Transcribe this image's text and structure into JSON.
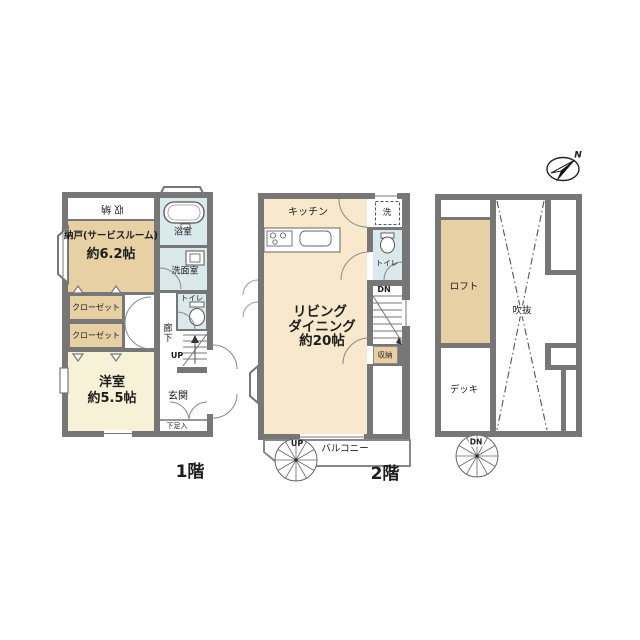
{
  "compass": {
    "north": "N"
  },
  "colors": {
    "wall": "#777777",
    "room_tan": "#e6d0a4",
    "room_cream": "#f6f1d7",
    "room_peach": "#f8e9cd",
    "room_blue": "#d9e9ec"
  },
  "floor1": {
    "label": "1階",
    "closet_top": "収納",
    "service_room_name": "納戸(サービスルーム)",
    "service_room_size": "約6.2帖",
    "bathroom": "浴室",
    "washroom": "洗面室",
    "toilet": "トイレ",
    "closet1": "クローゼット",
    "closet2": "クローゼット",
    "hallway": "廊下",
    "stairs_up": "UP",
    "western_room_name": "洋室",
    "western_room_size": "約5.5帖",
    "entrance": "玄関",
    "shoe_cupboard": "下足入"
  },
  "floor2": {
    "label": "2階",
    "kitchen": "キッチン",
    "laundry": "洗",
    "toilet": "トイレ",
    "stairs_down": "DN",
    "living_line1": "リビング",
    "living_line2": "ダイニング",
    "living_size": "約20帖",
    "storage": "収納",
    "stairs_up": "UP",
    "balcony": "バルコニー"
  },
  "floor3": {
    "loft": "ロフト",
    "atrium": "吹抜",
    "deck": "デッキ",
    "stairs_down": "DN"
  }
}
